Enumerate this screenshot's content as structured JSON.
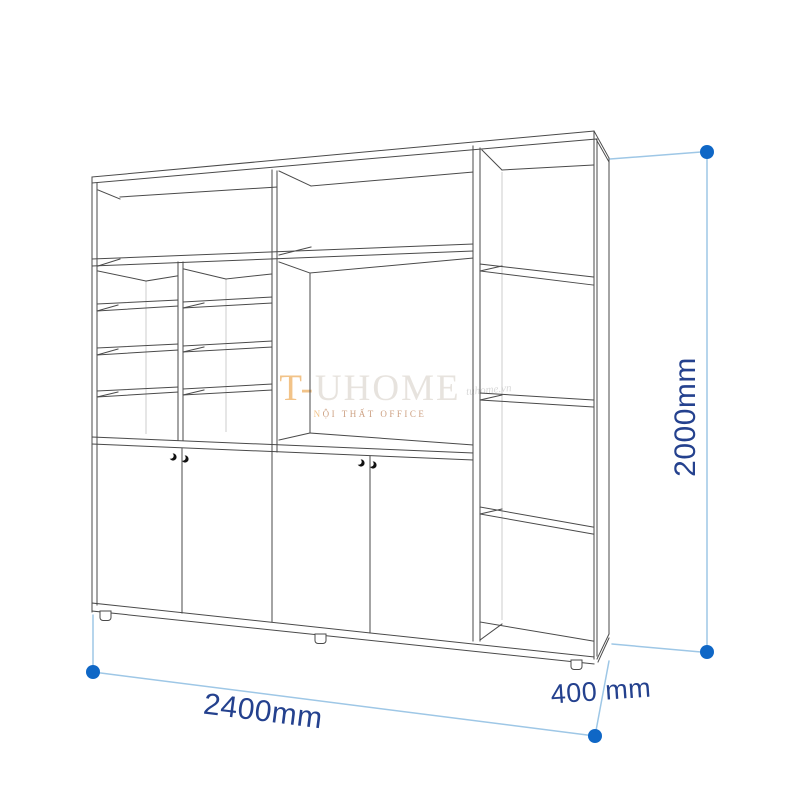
{
  "dimensions": {
    "width_label": "2400mm",
    "depth_label": "400 mm",
    "height_label": "2000mm"
  },
  "watermark": {
    "brand_prefix": "T-",
    "brand_suffix": "UHOME",
    "tagline_accent": "N",
    "tagline_rest": "ỘI THẤT OFFICE",
    "site": "tuhome.vn"
  },
  "colors": {
    "dimension_line": "#9ec7e6",
    "dimension_dot": "#0f67c6",
    "dimension_text": "#24418e",
    "drawing_line": "#4a4a4a",
    "faint_line": "#c9c9c9",
    "watermark_accent": "#f2c388",
    "watermark_main": "#e7e3de",
    "watermark_tagline": "#cda183",
    "watermark_site": "#d9d9d9"
  }
}
